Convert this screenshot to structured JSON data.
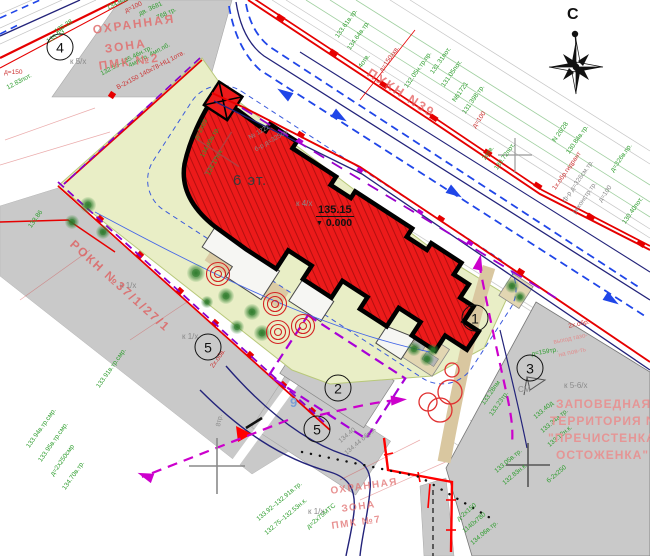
{
  "colors": {
    "building_fill": "#ec1a1a",
    "building_hatch": "#a50d0d",
    "outline": "#000000",
    "road_red": "#e60000",
    "navy": "#23237a",
    "traffic_blue": "#2046e8",
    "magenta": "#cc00cc",
    "violet": "#9a00cc",
    "green_area": "#e9eec6",
    "gray_block": "#c9c9c9",
    "tan": "#d9c7a0",
    "annotation_green": "#2f9e2f",
    "annotation_red": "#cc3333",
    "zone_text": "#e08f8f"
  },
  "compass": {
    "north_label": "С"
  },
  "building": {
    "floors": "6 эт.",
    "elevation": "135.15",
    "elevation_zero": "0.000"
  },
  "plan_markers": [
    {
      "label": "4",
      "x": 60,
      "y": 47
    },
    {
      "label": "1",
      "x": 475,
      "y": 318
    },
    {
      "label": "2",
      "x": 338,
      "y": 388
    },
    {
      "label": "3",
      "x": 530,
      "y": 368
    },
    {
      "label": "5",
      "x": 208,
      "y": 347
    },
    {
      "label": "5",
      "x": 317,
      "y": 429
    }
  ],
  "annotations": [
    {
      "t": "135.38",
      "x": 54,
      "y": 30,
      "r": -33,
      "c": "c-g"
    },
    {
      "t": "135.93",
      "x": 46,
      "y": 40,
      "r": -33,
      "c": "c-g"
    },
    {
      "t": "134.93в",
      "x": 106,
      "y": 6,
      "r": -25,
      "c": "c-g"
    },
    {
      "t": "д=100",
      "x": 124,
      "y": 9,
      "r": -25,
      "c": "c-r"
    },
    {
      "t": "дв. 3681",
      "x": 138,
      "y": 12,
      "r": -25,
      "c": "c-g"
    },
    {
      "t": "768 тр.",
      "x": 156,
      "y": 16,
      "r": -25,
      "c": "c-g"
    },
    {
      "t": "132.55–135.46н.тр.",
      "x": 100,
      "y": 72,
      "r": -28,
      "c": "c-g"
    },
    {
      "t": "В-2х150 140х78-НЦ 1отв.",
      "x": 116,
      "y": 86,
      "r": -28,
      "c": "c-r"
    },
    {
      "t": "д=150",
      "x": 4,
      "y": 70,
      "r": 0,
      "c": "c-r"
    },
    {
      "t": "12.83пот.",
      "x": 6,
      "y": 86,
      "r": -28,
      "c": "c-g"
    },
    {
      "t": "4мп.тр. 4мп.пб.",
      "x": 128,
      "y": 64,
      "r": -28,
      "c": "c-g"
    },
    {
      "t": "133.86",
      "x": 28,
      "y": 226,
      "r": -55,
      "c": "c-g"
    },
    {
      "t": "133.61в.тр.",
      "x": 335,
      "y": 36,
      "r": -55,
      "c": "c-g"
    },
    {
      "t": "134.64в.тр.",
      "x": 347,
      "y": 48,
      "r": -55,
      "c": "c-g"
    },
    {
      "t": "4отв.",
      "x": 358,
      "y": 66,
      "r": -55,
      "c": "c-g"
    },
    {
      "t": "д=150хкв.",
      "x": 379,
      "y": 70,
      "r": -55,
      "c": "c-r"
    },
    {
      "t": "132.05н.тр.пр.",
      "x": 404,
      "y": 86,
      "r": -55,
      "c": "c-g"
    },
    {
      "t": "131.31пот.",
      "x": 430,
      "y": 72,
      "r": -55,
      "c": "c-g"
    },
    {
      "t": "131.05пот.",
      "x": 441,
      "y": 85,
      "r": -55,
      "c": "c-g"
    },
    {
      "t": "N61721",
      "x": 452,
      "y": 100,
      "r": -55,
      "c": "c-g"
    },
    {
      "t": "131.398.тр.",
      "x": 462,
      "y": 112,
      "r": -55,
      "c": "c-g"
    },
    {
      "t": "д=100",
      "x": 472,
      "y": 126,
      "r": -55,
      "c": "c-r"
    },
    {
      "t": "2отв.",
      "x": 482,
      "y": 158,
      "r": -55,
      "c": "c-g"
    },
    {
      "t": "130.72пот.",
      "x": 494,
      "y": 168,
      "r": -55,
      "c": "c-g"
    },
    {
      "t": "N 26/28",
      "x": 552,
      "y": 140,
      "r": -55,
      "c": "c-g"
    },
    {
      "t": "130.84в.тр.",
      "x": 566,
      "y": 152,
      "r": -55,
      "c": "c-g"
    },
    {
      "t": "1х.обр.гидрант",
      "x": 552,
      "y": 188,
      "r": -55,
      "c": "c-r"
    },
    {
      "t": "ф-р д=326см.тр.",
      "x": 562,
      "y": 200,
      "r": -55,
      "c": "c-gray"
    },
    {
      "t": "реконстр.тр.",
      "x": 572,
      "y": 212,
      "r": -55,
      "c": "c-gray"
    },
    {
      "t": "д=100",
      "x": 598,
      "y": 200,
      "r": -55,
      "c": "c-gray"
    },
    {
      "t": "130.40пот.",
      "x": 622,
      "y": 222,
      "r": -55,
      "c": "c-g"
    },
    {
      "t": "д=326в.пр.",
      "x": 610,
      "y": 170,
      "r": -55,
      "c": "c-g"
    },
    {
      "t": "д=2х69",
      "x": 194,
      "y": 138,
      "r": -62,
      "c": "c-g"
    },
    {
      "t": "134.40в.тр.",
      "x": 200,
      "y": 156,
      "r": -62,
      "c": "c-g"
    },
    {
      "t": "134.17н.к.",
      "x": 206,
      "y": 174,
      "r": -62,
      "c": "c-g"
    },
    {
      "t": "№ 1222",
      "x": 248,
      "y": 136,
      "r": -30,
      "c": "c-gray"
    },
    {
      "t": "б-р д=325см",
      "x": 254,
      "y": 148,
      "r": -30,
      "c": "c-gray"
    },
    {
      "t": "133.94в.тр.смр.",
      "x": 26,
      "y": 446,
      "r": -55,
      "c": "c-g"
    },
    {
      "t": "133.95в.тр.смр.",
      "x": 38,
      "y": 460,
      "r": -55,
      "c": "c-g"
    },
    {
      "t": "д=2х250смр",
      "x": 50,
      "y": 474,
      "r": -55,
      "c": "c-g"
    },
    {
      "t": "134.70в.тр.",
      "x": 62,
      "y": 488,
      "r": -55,
      "c": "c-g"
    },
    {
      "t": "133.91в.тр.смр.",
      "x": 96,
      "y": 386,
      "r": -55,
      "c": "c-g"
    },
    {
      "t": "133.92–132.91в.тр.",
      "x": 256,
      "y": 518,
      "r": -40,
      "c": "c-g"
    },
    {
      "t": "132.75–132.53н.к.",
      "x": 264,
      "y": 532,
      "r": -40,
      "c": "c-g"
    },
    {
      "t": "д=2х75МТС",
      "x": 306,
      "y": 526,
      "r": -40,
      "c": "c-g"
    },
    {
      "t": "133.05в.тр.",
      "x": 494,
      "y": 470,
      "r": -40,
      "c": "c-g"
    },
    {
      "t": "132.83н.к.",
      "x": 502,
      "y": 482,
      "r": -40,
      "c": "c-g"
    },
    {
      "t": "д-2х150",
      "x": 456,
      "y": 518,
      "r": -40,
      "c": "c-g"
    },
    {
      "t": "1140х780",
      "x": 462,
      "y": 530,
      "r": -40,
      "c": "c-g"
    },
    {
      "t": "134.06в.тр.",
      "x": 470,
      "y": 542,
      "r": -40,
      "c": "c-g"
    },
    {
      "t": "133.40д",
      "x": 533,
      "y": 416,
      "r": -40,
      "c": "c-g"
    },
    {
      "t": "133.34а тр.",
      "x": 540,
      "y": 430,
      "r": -40,
      "c": "c-g"
    },
    {
      "t": "133.12н.к.",
      "x": 547,
      "y": 444,
      "r": -40,
      "c": "c-g"
    },
    {
      "t": "б-2х250",
      "x": 546,
      "y": 480,
      "r": -40,
      "c": "c-g"
    },
    {
      "t": "133.28пм",
      "x": 481,
      "y": 403,
      "r": -55,
      "c": "c-g"
    },
    {
      "t": "133.23тр.",
      "x": 489,
      "y": 414,
      "r": -55,
      "c": "c-g"
    },
    {
      "t": "2х.обв.",
      "x": 210,
      "y": 366,
      "r": -55,
      "c": "c-r"
    },
    {
      "t": "выход газо-",
      "x": 553,
      "y": 340,
      "r": -12,
      "c": "c-pink"
    },
    {
      "t": "на пов-ть",
      "x": 558,
      "y": 353,
      "r": -12,
      "c": "c-pink"
    },
    {
      "t": "2х.обр.",
      "x": 568,
      "y": 324,
      "r": -12,
      "c": "c-r"
    },
    {
      "t": "СМ",
      "x": 518,
      "y": 386,
      "r": 0,
      "c": "c-gray",
      "s": 8
    },
    {
      "t": "134.40",
      "x": 338,
      "y": 440,
      "r": -40,
      "c": "c-gray"
    },
    {
      "t": "134.44 обр.А",
      "x": 344,
      "y": 452,
      "r": -40,
      "c": "c-gray"
    },
    {
      "t": "д=159тр.",
      "x": 531,
      "y": 352,
      "r": -10,
      "c": "c-g"
    },
    {
      "t": "8тр.",
      "x": 216,
      "y": 426,
      "r": -80,
      "c": "c-gray"
    },
    {
      "t": "9",
      "x": 290,
      "y": 396,
      "r": 0,
      "c": "c-blue",
      "s": 13
    },
    {
      "t": "к 5/х",
      "x": 70,
      "y": 58,
      "r": 0,
      "c": "c-gray",
      "s": 8
    },
    {
      "t": "к 1/х",
      "x": 120,
      "y": 282,
      "r": 0,
      "c": "c-gray",
      "s": 8
    },
    {
      "t": "к 1/х",
      "x": 182,
      "y": 333,
      "r": 0,
      "c": "c-gray",
      "s": 8
    },
    {
      "t": "к 5-6/х",
      "x": 564,
      "y": 382,
      "r": 0,
      "c": "c-gray",
      "s": 8
    },
    {
      "t": "к 1/х",
      "x": 308,
      "y": 508,
      "r": 0,
      "c": "c-gray",
      "s": 8
    },
    {
      "t": "к 4/х",
      "x": 296,
      "y": 200,
      "r": 0,
      "c": "c-gray",
      "s": 8
    },
    {
      "t": "ОХРАННАЯ",
      "x": 92,
      "y": 24,
      "r": -8,
      "c": "c-zone1",
      "s": 12
    },
    {
      "t": "ЗОНА",
      "x": 104,
      "y": 43,
      "r": -8,
      "c": "c-zone1",
      "s": 12
    },
    {
      "t": "ПМК №2",
      "x": 98,
      "y": 60,
      "r": -8,
      "c": "c-zone1",
      "s": 12
    },
    {
      "t": "ОХРАННАЯ",
      "x": 330,
      "y": 487,
      "r": -8,
      "c": "c-zone2",
      "s": 10
    },
    {
      "t": "ЗОНА",
      "x": 341,
      "y": 505,
      "r": -8,
      "c": "c-zone2",
      "s": 10
    },
    {
      "t": "ПМК №7",
      "x": 331,
      "y": 522,
      "r": -8,
      "c": "c-zone2",
      "s": 10
    },
    {
      "t": "ЗАПОВЕДНАЯ",
      "x": 556,
      "y": 398,
      "r": 0,
      "c": "c-zone3",
      "s": 12
    },
    {
      "t": "ТЕРРИТОРИЯ  N2",
      "x": 550,
      "y": 415,
      "r": 0,
      "c": "c-zone3",
      "s": 12
    },
    {
      "t": "\"ПРЕЧИСТЕНКА-",
      "x": 548,
      "y": 432,
      "r": 0,
      "c": "c-zone3",
      "s": 12
    },
    {
      "t": "ОСТОЖЕНКА\"",
      "x": 556,
      "y": 449,
      "r": 0,
      "c": "c-zone3",
      "s": 12
    },
    {
      "t": "РОКН №37/1/27/1",
      "x": 76,
      "y": 238,
      "r": 42,
      "c": "c-zone4",
      "s": 12
    },
    {
      "t": "ПУКН N39",
      "x": 372,
      "y": 66,
      "r": 33,
      "c": "c-zone4",
      "s": 13
    }
  ],
  "symbols": {
    "trees": [
      {
        "x": 88,
        "y": 205,
        "r": 8
      },
      {
        "x": 72,
        "y": 222,
        "r": 7
      },
      {
        "x": 103,
        "y": 232,
        "r": 7
      },
      {
        "x": 196,
        "y": 273,
        "r": 9
      },
      {
        "x": 226,
        "y": 296,
        "r": 8
      },
      {
        "x": 252,
        "y": 312,
        "r": 8
      },
      {
        "x": 237,
        "y": 327,
        "r": 7
      },
      {
        "x": 262,
        "y": 333,
        "r": 8
      },
      {
        "x": 207,
        "y": 302,
        "r": 6
      },
      {
        "x": 512,
        "y": 286,
        "r": 7
      },
      {
        "x": 520,
        "y": 297,
        "r": 6
      },
      {
        "x": 414,
        "y": 349,
        "r": 7
      },
      {
        "x": 427,
        "y": 359,
        "r": 7
      },
      {
        "x": 433,
        "y": 350,
        "r": 6
      }
    ],
    "targets": [
      {
        "x": 218,
        "y": 274
      },
      {
        "x": 275,
        "y": 304
      },
      {
        "x": 278,
        "y": 332
      },
      {
        "x": 303,
        "y": 326
      }
    ],
    "red_circles": [
      {
        "x": 450,
        "y": 392,
        "r": 12
      },
      {
        "x": 440,
        "y": 410,
        "r": 12
      },
      {
        "x": 428,
        "y": 402,
        "r": 9
      },
      {
        "x": 452,
        "y": 370,
        "r": 7
      }
    ],
    "crosses": [
      {
        "x": 218,
        "y": 153,
        "l": 50,
        "rot": 33,
        "col": "#b04040",
        "w": 1.4
      },
      {
        "x": 515,
        "y": 155,
        "l": 34,
        "rot": 0,
        "col": "#999999",
        "w": 1.2
      },
      {
        "x": 217,
        "y": 466,
        "l": 56,
        "rot": 0,
        "col": "#8a8a8a",
        "w": 1.6
      },
      {
        "x": 528,
        "y": 465,
        "l": 44,
        "rot": 0,
        "col": "#555555",
        "w": 1.6
      }
    ]
  }
}
